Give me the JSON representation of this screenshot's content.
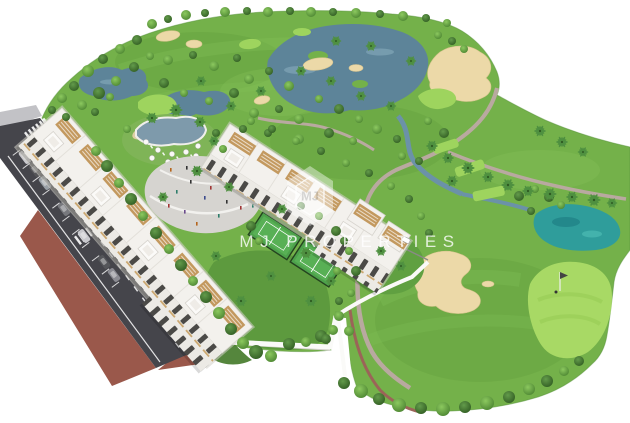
{
  "watermark": {
    "text": "MJ PROPERTIES",
    "monogram": "MJ"
  },
  "palette": {
    "fairway": "#74b14a",
    "rough_dark": "#5f9c3c",
    "green_light": "#9ed45e",
    "putting_green": "#a8d965",
    "sand": "#ecd9a8",
    "water": "#5d8499",
    "water_teal": "#2f9d9b",
    "asphalt": "#45454b",
    "paving": "#9a584b",
    "sidewalk": "#c2c2c6",
    "building": "#f3f1ed",
    "facade": "#eceae5",
    "window": "#4b4a47",
    "terrace_wood": "#c3995f",
    "court": "#4da14b",
    "plaza": "#d6d4d0",
    "pool": "#7e9aab",
    "path": "#b9a9a0",
    "wall_white": "#fafaf8"
  }
}
